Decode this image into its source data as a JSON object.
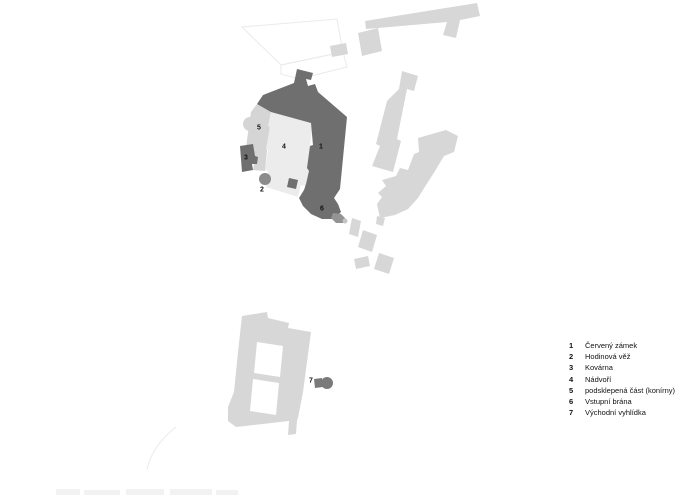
{
  "legend": {
    "items": [
      {
        "number": "1",
        "label": "Červený zámek"
      },
      {
        "number": "2",
        "label": "Hodinová věž"
      },
      {
        "number": "3",
        "label": "Kovárna"
      },
      {
        "number": "4",
        "label": "Nádvoří"
      },
      {
        "number": "5",
        "label": "podsklepená část (konírny)"
      },
      {
        "number": "6",
        "label": "Vstupní brána"
      },
      {
        "number": "7",
        "label": "Východní vyhlídka"
      }
    ]
  },
  "map": {
    "colors": {
      "castle_dark": "#6f6f6f",
      "courtyard_light": "#ececec",
      "cellared_gray": "#d5d5d5",
      "building_gray": "#d7d7d7",
      "clock_tower_gray": "#8b8b8b",
      "gate_tail_gray": "#949494",
      "gate_tip_gray": "#c4c4c4",
      "viewpoint_dark": "#7a7a7a",
      "faint_gray": "#f2f2f2",
      "background": "#ffffff"
    }
  }
}
